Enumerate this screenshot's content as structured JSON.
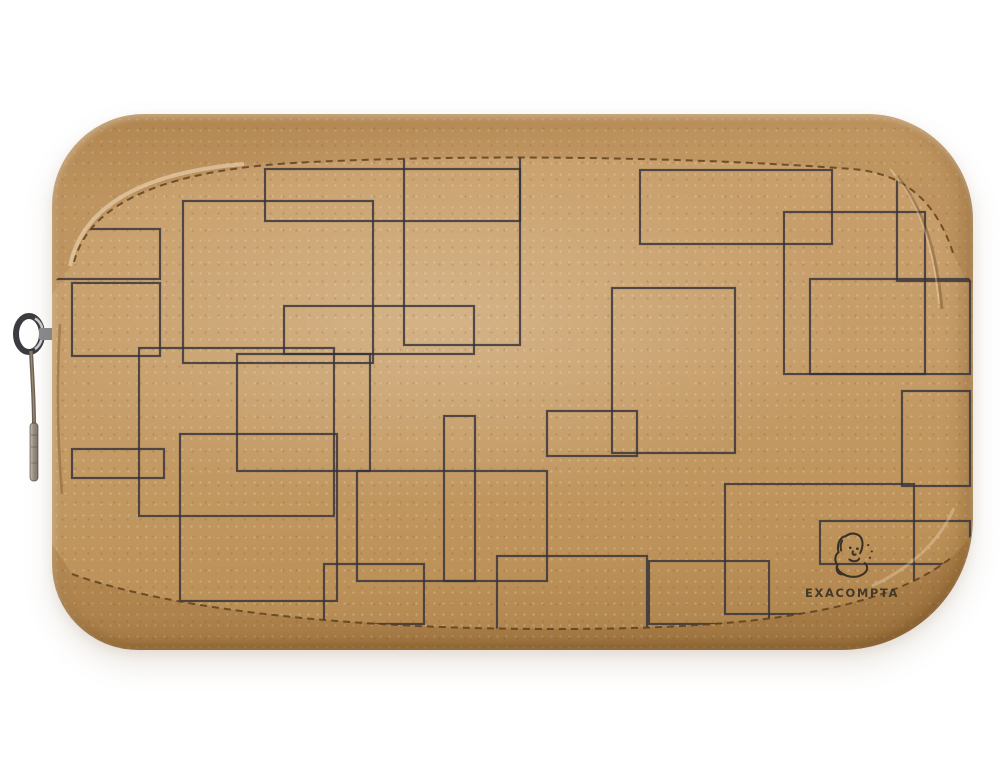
{
  "scene": {
    "description": "Product photo on white background: kraft-paper zippered pouch (pencil case) with printed overlapping black rectangle pattern, metal zip pull hanging on the left, brand logo printed bottom-right",
    "background_color": "#ffffff"
  },
  "product": {
    "type": "kraft paper zip pouch / pencil case",
    "brand": "EXACOMPTA",
    "logo_icon": "exacompta-face-sketch-icon"
  },
  "logo": {
    "text": "EXACOMPTA"
  },
  "colors": {
    "body_tan": "#c19a67",
    "body_tan_light": "#cfa873",
    "body_tan_dark": "#a87f4a",
    "pattern_line": "#34323a",
    "stitch_thread": "#5a3c1c",
    "logo_ink": "#3a3226",
    "zipper_metal": "#9b9ba1",
    "zipper_metal_dark": "#3c3c40",
    "zipper_strap": "#6f6156",
    "background": "#ffffff"
  },
  "pattern": {
    "style": "overlapping rectangle outlines printed on kraft",
    "stroke_width": 2.2,
    "rects": [
      {
        "x": 131,
        "y": 87,
        "w": 190,
        "h": 162
      },
      {
        "x": 213,
        "y": 55,
        "w": 255,
        "h": 52
      },
      {
        "x": 352,
        "y": -10,
        "w": 116,
        "h": 241
      },
      {
        "x": 20,
        "y": 169,
        "w": 88,
        "h": 73
      },
      {
        "x": 87,
        "y": 234,
        "w": 195,
        "h": 168
      },
      {
        "x": 232,
        "y": 192,
        "w": 190,
        "h": 48
      },
      {
        "x": 588,
        "y": 56,
        "w": 192,
        "h": 74
      },
      {
        "x": 732,
        "y": 98,
        "w": 141,
        "h": 162
      },
      {
        "x": 560,
        "y": 174,
        "w": 123,
        "h": 165
      },
      {
        "x": 758,
        "y": 165,
        "w": 160,
        "h": 95
      },
      {
        "x": 128,
        "y": 320,
        "w": 157,
        "h": 167
      },
      {
        "x": 20,
        "y": 335,
        "w": 92,
        "h": 29
      },
      {
        "x": 185,
        "y": 240,
        "w": 133,
        "h": 117
      },
      {
        "x": 495,
        "y": 297,
        "w": 90,
        "h": 45
      },
      {
        "x": 673,
        "y": 370,
        "w": 189,
        "h": 130
      },
      {
        "x": 768,
        "y": 407,
        "w": 150,
        "h": 43
      },
      {
        "x": 272,
        "y": 450,
        "w": 100,
        "h": 60
      },
      {
        "x": 392,
        "y": 302,
        "w": 31,
        "h": 165
      },
      {
        "x": 305,
        "y": 357,
        "w": 190,
        "h": 110
      },
      {
        "x": 445,
        "y": 442,
        "w": 150,
        "h": 75
      },
      {
        "x": 845,
        "y": 47,
        "w": 73,
        "h": 120
      },
      {
        "x": -35,
        "y": 115,
        "w": 143,
        "h": 50
      },
      {
        "x": 597,
        "y": 447,
        "w": 120,
        "h": 63
      },
      {
        "x": 850,
        "y": 277,
        "w": 68,
        "h": 95
      }
    ]
  },
  "zipper": {
    "parts": [
      "metal-d-ring",
      "cord",
      "metal-ferrule-tip"
    ]
  }
}
